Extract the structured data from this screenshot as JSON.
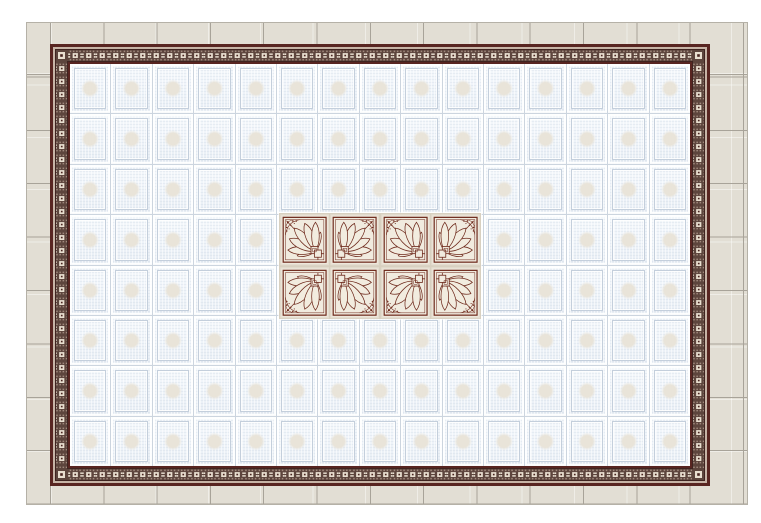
{
  "scene": {
    "kind": "tile-layout-render",
    "page_background": "#ffffff"
  },
  "outer_field": {
    "name": "plain beige ceramic tiles",
    "tile_color": "#e2ded4",
    "grout_color": "#a8a399",
    "tile_pitch_px": 53.3
  },
  "border_frame": {
    "name": "ornamental maroon listello border",
    "line_color": "#582521",
    "gap_color": "#c7b4a6",
    "band_background": "#5d453d",
    "band_cream": "#e9dfd0",
    "band_taupe": "#a18a7d",
    "band_dark": "#3f2420",
    "band_unit_px": 13.5
  },
  "inner_field": {
    "name": "embossed pale blue ceiling tiles",
    "columns": 15,
    "rows": 8,
    "tile_color": "#eef3f9",
    "grout_color": "#ccd5df",
    "bevel_color": "#c4cfdc",
    "medallion_tint": "#e9e4d9"
  },
  "center_inset": {
    "name": "fan-pattern decor tiles",
    "columns": 4,
    "rows": 2,
    "tile_background": "#eee8dc",
    "line_color": "#6e2a1c",
    "petal_fill": "#f2ecdf",
    "grout_color": "#d8d0c0",
    "orientations": [
      [
        "base",
        "flip-x",
        "base",
        "flip-x"
      ],
      [
        "flip-y",
        "flip-xy",
        "flip-y",
        "flip-xy"
      ]
    ]
  }
}
